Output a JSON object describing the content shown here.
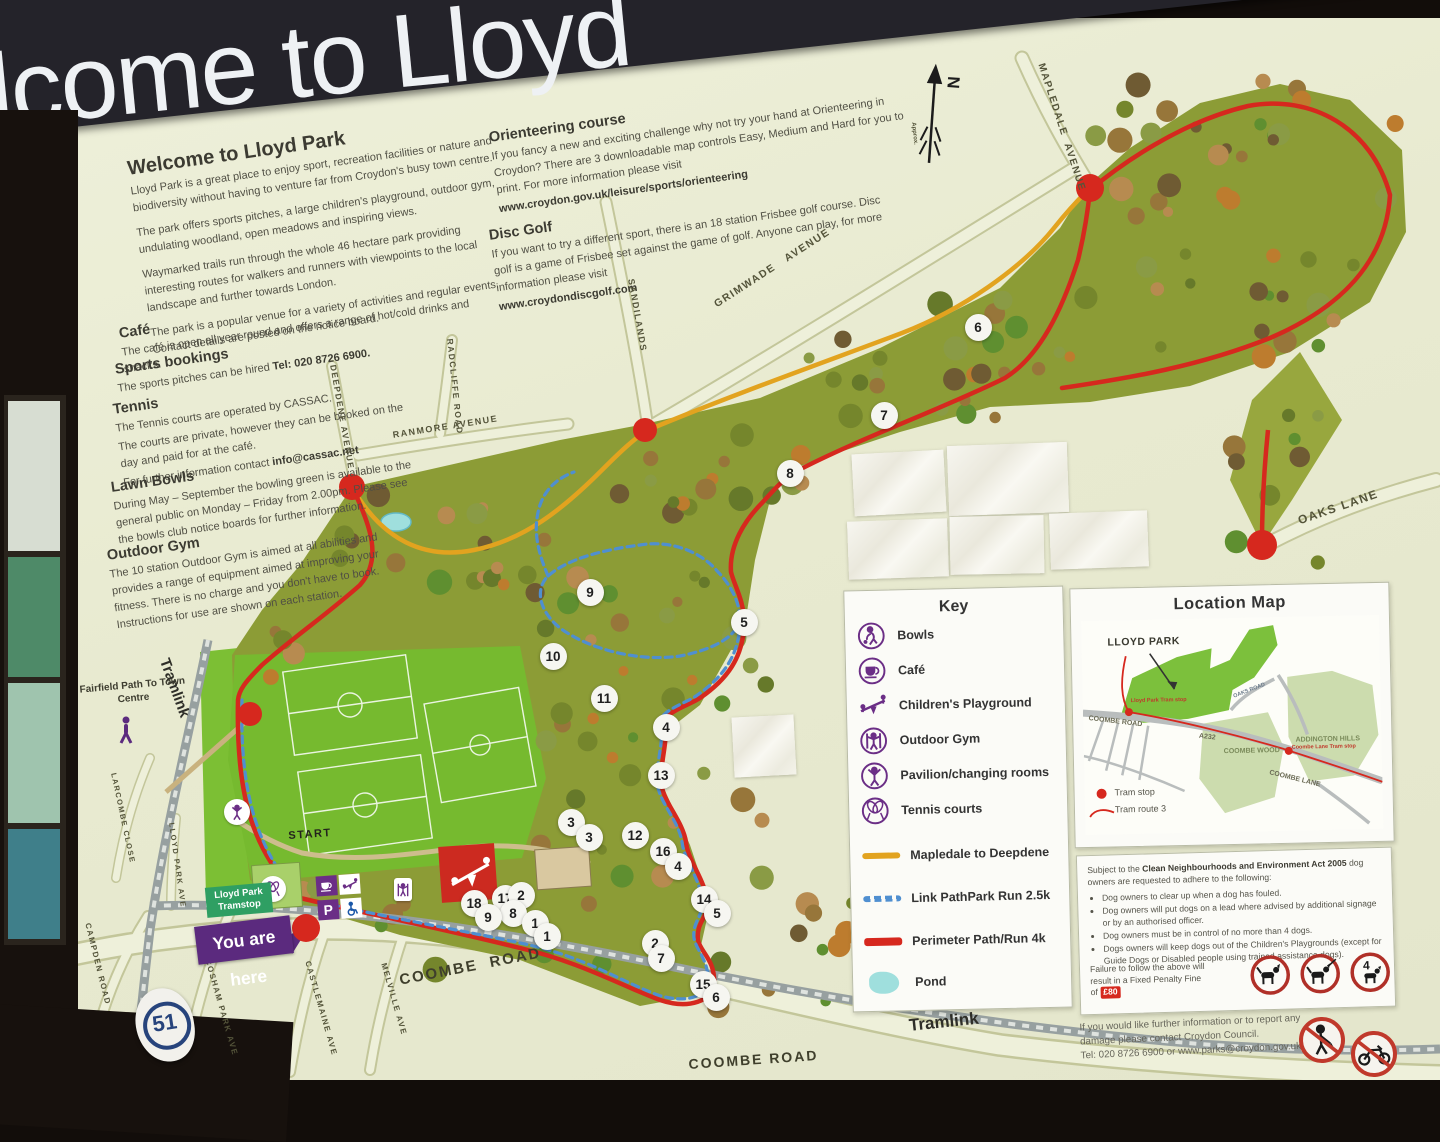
{
  "banner": {
    "partial_title": "lcome to Lloyd"
  },
  "intro": {
    "heading": "Welcome to Lloyd Park",
    "p1": "Lloyd Park is a great place to enjoy sport, recreation facilities or nature and biodiversity without having to venture far from Croydon's busy town centre.",
    "p2": "The park offers sports pitches, a large children's playground, outdoor gym, undulating woodland, open meadows and inspiring views.",
    "p3": "Waymarked trails run through the whole 46 hectare park providing interesting routes for walkers and runners with viewpoints to the local landscape and further towards London.",
    "p4": "The park is a popular venue for a variety of activities and regular events. Contact details are posted on the notice board."
  },
  "cafe": {
    "heading": "Café",
    "body": "The café is open all year round and offers a range of hot/cold drinks and snacks."
  },
  "sports_bookings": {
    "heading": "Sports bookings",
    "body_prefix": "The sports pitches can be hired ",
    "body_bold": "Tel: 020 8726 6900."
  },
  "tennis": {
    "heading": "Tennis",
    "line1": "The Tennis courts are operated by CASSAC.",
    "line2": "The courts are private, however they can be booked on the day and paid for at the café.",
    "line3_prefix": "For further information contact ",
    "line3_bold": "info@cassac.net"
  },
  "lawn_bowls": {
    "heading": "Lawn Bowls",
    "body": "During May – September the bowling green is available to the general public on Monday – Friday from 2.00pm. Please see the bowls club notice boards for further information."
  },
  "outdoor_gym": {
    "heading": "Outdoor Gym",
    "body": "The 10 station Outdoor Gym is aimed at all abilities and provides a range of equipment aimed at improving your fitness. There is no charge and you don't have to book. Instructions for use are shown on each station."
  },
  "orienteering": {
    "heading": "Orienteering course",
    "body": "If you fancy a new and exciting challenge why not try your hand at Orienteering in Croydon? There are 3 downloadable map controls Easy, Medium and Hard for you to print. For more information please visit",
    "url": "www.croydon.gov.uk/leisure/sports/orienteering"
  },
  "disc_golf": {
    "heading": "Disc Golf",
    "body": "If you want to try a different sport, there is an 18 station Frisbee golf course. Disc golf is a game of Frisbee set against the game of golf. Anyone can play, for more information please visit",
    "url": "www.croydondiscgolf.com"
  },
  "key": {
    "title": "Key",
    "items": [
      {
        "icon": "bowls-icon",
        "label": "Bowls"
      },
      {
        "icon": "cafe-icon",
        "label": "Café"
      },
      {
        "icon": "playground-icon",
        "label": "Children's Playground"
      },
      {
        "icon": "gym-icon",
        "label": "Outdoor Gym"
      },
      {
        "icon": "pavilion-icon",
        "label": "Pavilion/changing rooms"
      },
      {
        "icon": "tennis-icon",
        "label": "Tennis courts"
      }
    ],
    "routes": [
      {
        "label": "Mapledale to Deepdene",
        "color": "#e2a31f",
        "style": "solid"
      },
      {
        "label": "Link PathPark Run 2.5k",
        "color": "#4f8fd0",
        "style": "dashed"
      },
      {
        "label": "Perimeter Path/Run 4k",
        "color": "#d6281e",
        "style": "solid"
      }
    ],
    "pond_label": "Pond"
  },
  "location_map": {
    "title": "Location Map",
    "park_label": "LLOYD PARK",
    "coombe_road": "COOMBE ROAD",
    "a232": "A232",
    "coombe_wood": "COOMBE WOOD",
    "addington_hills": "ADDINGTON HILLS",
    "coombe_lane": "COOMBE LANE",
    "oaks_road": "OAKS ROAD",
    "lloyd_tram_stop": "Lloyd Park Tram stop",
    "coombe_tram_stop": "Coombe Lane Tram stop",
    "legend_stop": "Tram stop",
    "legend_route": "Tram route 3"
  },
  "dog_notice": {
    "prefix": "Subject to the ",
    "act": "Clean Neighbourhoods and Environment Act 2005",
    "suffix": " dog owners are requested to adhere to the following:",
    "bullets": [
      "Dog owners to clear up when a dog has fouled.",
      "Dog owners will put dogs on a lead where advised by additional signage or by an authorised officer.",
      "Dog owners must be in control of no more than 4 dogs.",
      "Dogs owners will keep dogs out of the Children's Playgrounds (except for Guide Dogs or Disabled people using trained assistance dogs)."
    ],
    "failure": "Failure to follow the above will result in a Fixed Penalty Fine of",
    "fine": "£80",
    "four_dogs": "4"
  },
  "footer": {
    "line1": "If you would like further information or to report any damage please contact Croydon Council.",
    "line2": "Tel: 020 8726 6900 or www.parks@croydon.gov.uk"
  },
  "map": {
    "labels": {
      "mapledale": "MAPLEDALE  AVENUE",
      "grimwade": "GRIMWADE   AVENUE",
      "sandilands": "SANDILANDS",
      "ranmore": "RANMORE AVENUE",
      "radcliffe": "RADCLIFFE ROAD",
      "deepdene": "DEEPDENE AVENUE",
      "oaks_lane": "OAKS LANE",
      "coombe_road_1": "COOMBE  ROAD",
      "coombe_road_2": "COOMBE ROAD",
      "tramlink_left": "Tramlink",
      "tramlink_bottom": "Tramlink",
      "campden": "CAMPDEN ROAD",
      "cosham": "COSHAM PARK AVE",
      "castlemaine": "CASTLEMAINE AVE",
      "melville": "MELVILLE AVE",
      "larcombe": "LARCOMBE CLOSE",
      "lloyd_park_ave": "LLOYD PARK AVE",
      "fairfield": "Fairfield Path\nTo Town Centre",
      "start": "START",
      "north": "N",
      "approx": "Approx."
    },
    "you_are_here": "You are here",
    "tramstop_tag": "Lloyd Park Tramstop",
    "sticker": "51",
    "stations": [
      {
        "x": 978,
        "y": 327,
        "n": "6"
      },
      {
        "x": 884,
        "y": 415,
        "n": "7"
      },
      {
        "x": 790,
        "y": 473,
        "n": "8"
      },
      {
        "x": 590,
        "y": 592,
        "n": "9"
      },
      {
        "x": 744,
        "y": 622,
        "n": "5"
      },
      {
        "x": 553,
        "y": 656,
        "n": "10"
      },
      {
        "x": 604,
        "y": 698,
        "n": "11"
      },
      {
        "x": 666,
        "y": 727,
        "n": "4"
      },
      {
        "x": 661,
        "y": 775,
        "n": "13"
      },
      {
        "x": 571,
        "y": 822,
        "n": "3"
      },
      {
        "x": 589,
        "y": 837,
        "n": "3"
      },
      {
        "x": 635,
        "y": 835,
        "n": "12"
      },
      {
        "x": 663,
        "y": 851,
        "n": "16"
      },
      {
        "x": 678,
        "y": 866,
        "n": "4"
      },
      {
        "x": 505,
        "y": 898,
        "n": "17"
      },
      {
        "x": 521,
        "y": 895,
        "n": "2"
      },
      {
        "x": 513,
        "y": 913,
        "n": "8"
      },
      {
        "x": 474,
        "y": 903,
        "n": "18"
      },
      {
        "x": 488,
        "y": 917,
        "n": "9"
      },
      {
        "x": 535,
        "y": 923,
        "n": "1"
      },
      {
        "x": 547,
        "y": 936,
        "n": "1"
      },
      {
        "x": 704,
        "y": 899,
        "n": "14"
      },
      {
        "x": 717,
        "y": 913,
        "n": "5"
      },
      {
        "x": 655,
        "y": 943,
        "n": "2"
      },
      {
        "x": 661,
        "y": 958,
        "n": "7"
      },
      {
        "x": 703,
        "y": 984,
        "n": "15"
      },
      {
        "x": 716,
        "y": 997,
        "n": "6"
      }
    ]
  },
  "colors": {
    "accent_purple": "#6b2e86",
    "path_red": "#d6281e",
    "path_orange": "#e2a31f",
    "path_blue": "#4f8fd0",
    "pond": "#9fdfdd",
    "tramstop_green": "#2f9f63",
    "park_olive": "#8c9c36",
    "park_bright": "#76ba2f"
  }
}
